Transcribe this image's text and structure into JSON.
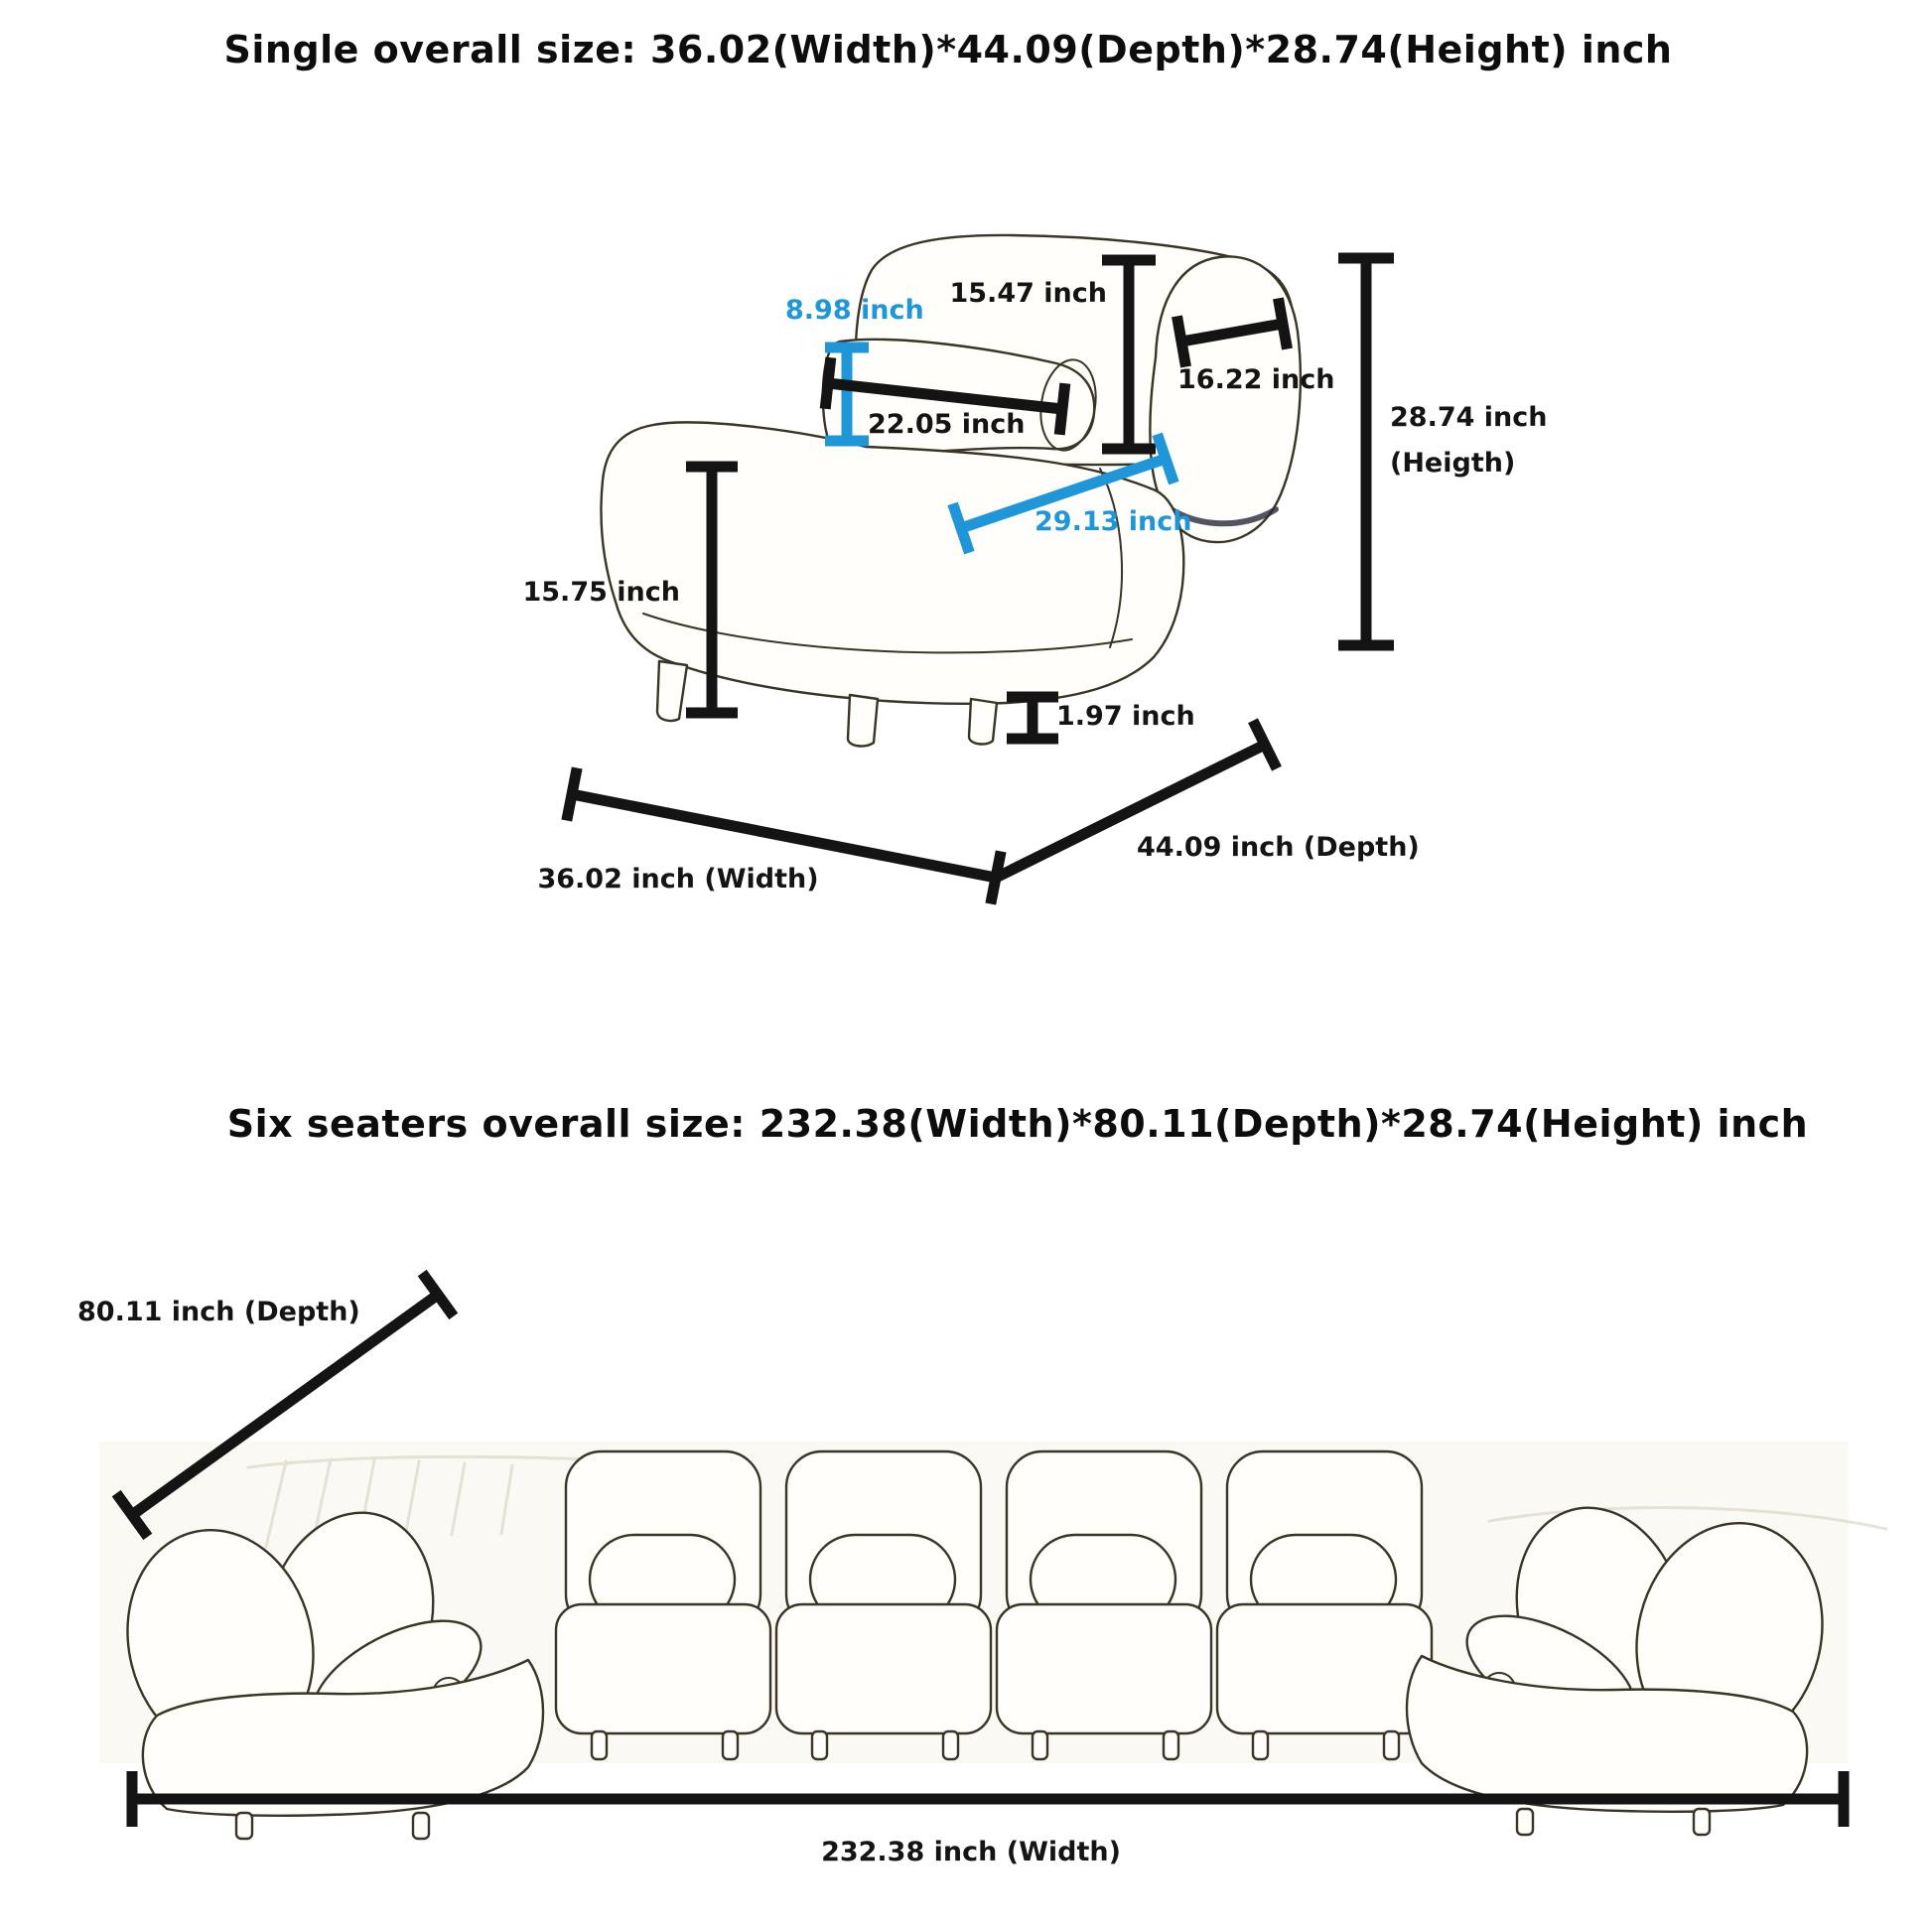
{
  "colors": {
    "dimension_black": "#141414",
    "dimension_blue": "#1f96d7",
    "sketch_stroke": "#3a3426"
  },
  "single_diagram": {
    "title": "Single overall size: 36.02(Width)*44.09(Depth)*28.74(Height) inch",
    "dims": {
      "back_height": "15.47 inch",
      "pillow_height": "8.98 inch",
      "pillow_length": "22.05 inch",
      "backrest_width": "16.22 inch",
      "overall_height_line1": "28.74 inch",
      "overall_height_line2": "(Heigth)",
      "seat_height": "15.75 inch",
      "seat_depth": "29.13 inch",
      "leg_height": "1.97 inch",
      "overall_width": "36.02 inch (Width)",
      "overall_depth": "44.09 inch (Depth)"
    }
  },
  "six_seater_diagram": {
    "title": "Six seaters overall size: 232.38(Width)*80.11(Depth)*28.74(Height) inch",
    "dims": {
      "overall_depth": "80.11 inch (Depth)",
      "overall_width": "232.38 inch (Width)"
    }
  }
}
